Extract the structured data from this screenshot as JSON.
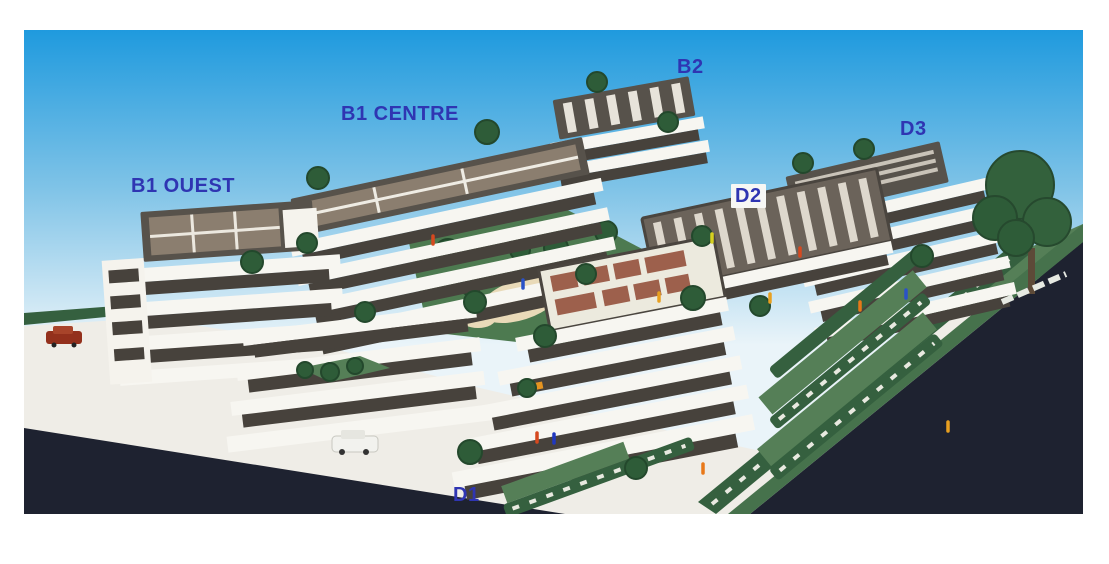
{
  "meta": {
    "description": "Photograph of an architectural scale model of a terraced apartment residential complex, annotated with blue building-block labels"
  },
  "labels": [
    {
      "id": "b1-ouest",
      "text": "B1 OUEST"
    },
    {
      "id": "b1-centre",
      "text": "B1 CENTRE"
    },
    {
      "id": "b2",
      "text": "B2"
    },
    {
      "id": "d3",
      "text": "D3"
    },
    {
      "id": "d2",
      "text": "D2"
    },
    {
      "id": "d1",
      "text": "D1"
    }
  ],
  "colors": {
    "label_blue": "#2f35b2",
    "sky_top": "#1f9ade",
    "sky_mid": "#7fc3e7",
    "sky_horizon": "#eaf4f9",
    "ground_white": "#efede7",
    "road_dark": "#1e2230",
    "facade_white": "#f5f3ed",
    "window_dark": "#47423c",
    "roof_dark": "#57524b",
    "roof_panel_brown": "#8b7e6f",
    "tree_green": "#2e5c38",
    "hedge_green": "#35603f",
    "lawn_green": "#557f57",
    "page_background": "#ffffff"
  }
}
